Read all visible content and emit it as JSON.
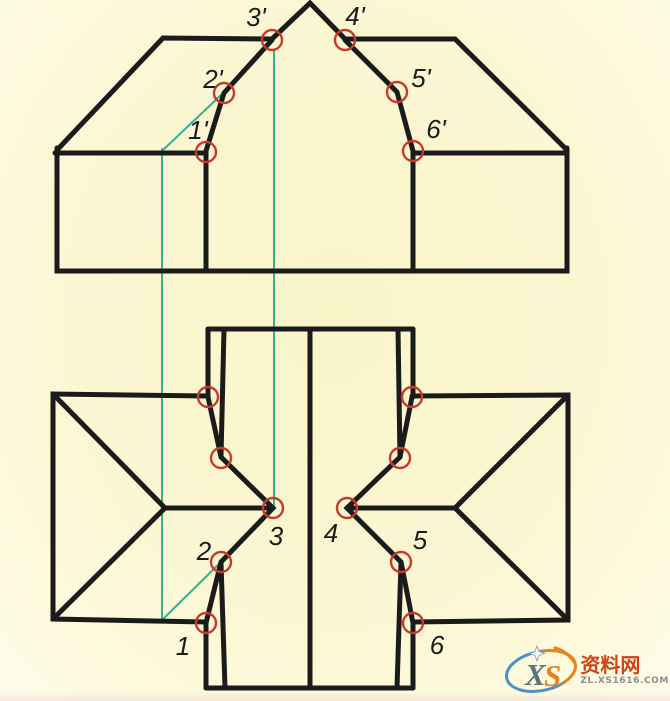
{
  "title": "orthographic-projection-construction-drawing",
  "colors": {
    "background": "#FBF7D3",
    "line": "#1B1B1B",
    "marker": "#C8392B",
    "construction": "#34B18F",
    "watermark_brand": "#CE4518",
    "watermark_domain": "#8E8E8E",
    "logo_blue": "#4E8FC4",
    "logo_orange": "#E8831D",
    "logo_x": "#5E7082"
  },
  "front_view": {
    "name": "front view (elevation)",
    "points": [
      {
        "label": "1'",
        "x": 206,
        "y": 152,
        "label_x": 198,
        "label_y": 139
      },
      {
        "label": "2'",
        "x": 224,
        "y": 93,
        "label_x": 213,
        "label_y": 88
      },
      {
        "label": "3'",
        "x": 272,
        "y": 40,
        "label_x": 256,
        "label_y": 26
      },
      {
        "label": "4'",
        "x": 345,
        "y": 40,
        "label_x": 355,
        "label_y": 25
      },
      {
        "label": "5'",
        "x": 397,
        "y": 92,
        "label_x": 421,
        "label_y": 87
      },
      {
        "label": "6'",
        "x": 413,
        "y": 151,
        "label_x": 436,
        "label_y": 138
      }
    ]
  },
  "top_view": {
    "name": "top view (plan)",
    "points": [
      {
        "label": "",
        "x": 208,
        "y": 397
      },
      {
        "label": "",
        "x": 221,
        "y": 458
      },
      {
        "label": "3",
        "x": 273,
        "y": 508,
        "label_x": 276,
        "label_y": 545
      },
      {
        "label": "2",
        "x": 221,
        "y": 562,
        "label_x": 204,
        "label_y": 560
      },
      {
        "label": "1",
        "x": 206,
        "y": 623,
        "label_x": 183,
        "label_y": 655
      },
      {
        "label": "",
        "x": 412,
        "y": 397
      },
      {
        "label": "",
        "x": 400,
        "y": 458
      },
      {
        "label": "4",
        "x": 347,
        "y": 508,
        "label_x": 331,
        "label_y": 542
      },
      {
        "label": "5",
        "x": 401,
        "y": 562,
        "label_x": 420,
        "label_y": 549
      },
      {
        "label": "6",
        "x": 413,
        "y": 623,
        "label_x": 437,
        "label_y": 654
      }
    ]
  },
  "drawing": {
    "stroke_width_outline": 5,
    "stroke_width_construction": 2,
    "marker_radius": 10,
    "marker_stroke_width": 2.4,
    "front_outlines": [
      [
        [
          57,
          150
        ],
        [
          163,
          38
        ],
        [
          272,
          39
        ],
        [
          310,
          3
        ],
        [
          345,
          39
        ],
        [
          455,
          39
        ],
        [
          567,
          150
        ]
      ],
      [
        [
          57,
          148
        ],
        [
          57,
          271
        ],
        [
          567,
          271
        ],
        [
          567,
          148
        ]
      ],
      [
        [
          55,
          153
        ],
        [
          206,
          153
        ]
      ],
      [
        [
          414,
          153
        ],
        [
          567,
          153
        ]
      ],
      [
        [
          272,
          40
        ],
        [
          224,
          93
        ],
        [
          206,
          151
        ]
      ],
      [
        [
          345,
          40
        ],
        [
          397,
          92
        ],
        [
          413,
          151
        ]
      ],
      [
        [
          206,
          152
        ],
        [
          206,
          271
        ]
      ],
      [
        [
          413,
          152
        ],
        [
          413,
          271
        ]
      ]
    ],
    "top_outlines": [
      [
        [
          208,
          329
        ],
        [
          413,
          329
        ]
      ],
      [
        [
          310,
          329
        ],
        [
          310,
          688
        ]
      ],
      [
        [
          206,
          688
        ],
        [
          413,
          688
        ]
      ],
      [
        [
          208,
          329
        ],
        [
          208,
          397
        ]
      ],
      [
        [
          224,
          329
        ],
        [
          221,
          457
        ]
      ],
      [
        [
          398,
          329
        ],
        [
          400,
          457
        ]
      ],
      [
        [
          413,
          329
        ],
        [
          413,
          397
        ]
      ],
      [
        [
          208,
          396
        ],
        [
          53,
          394
        ],
        [
          53,
          619
        ],
        [
          206,
          622
        ]
      ],
      [
        [
          53,
          394
        ],
        [
          165,
          508
        ],
        [
          53,
          619
        ]
      ],
      [
        [
          165,
          508
        ],
        [
          273,
          508
        ]
      ],
      [
        [
          208,
          397
        ],
        [
          221,
          457
        ],
        [
          273,
          508
        ],
        [
          221,
          562
        ],
        [
          206,
          623
        ]
      ],
      [
        [
          206,
          623
        ],
        [
          206,
          688
        ]
      ],
      [
        [
          221,
          563
        ],
        [
          225,
          688
        ]
      ],
      [
        [
          412,
          396
        ],
        [
          568,
          395
        ],
        [
          568,
          620
        ],
        [
          413,
          622
        ]
      ],
      [
        [
          568,
          395
        ],
        [
          455,
          508
        ],
        [
          568,
          620
        ]
      ],
      [
        [
          347,
          508
        ],
        [
          455,
          508
        ]
      ],
      [
        [
          412,
          397
        ],
        [
          400,
          457
        ],
        [
          347,
          508
        ],
        [
          401,
          562
        ],
        [
          413,
          623
        ]
      ],
      [
        [
          413,
          623
        ],
        [
          413,
          688
        ]
      ],
      [
        [
          401,
          563
        ],
        [
          397,
          688
        ]
      ]
    ],
    "construction_lines": [
      [
        [
          162,
          149
        ],
        [
          162,
          620
        ]
      ],
      [
        [
          274,
          50
        ],
        [
          274,
          508
        ]
      ],
      [
        [
          163,
          150
        ],
        [
          221,
          95
        ]
      ],
      [
        [
          221,
          562
        ],
        [
          162,
          620
        ]
      ]
    ]
  },
  "watermark": {
    "brand": "资料网",
    "domain": "ZL.XS1616.COM",
    "logo_letter_x": "X",
    "logo_letter_s": "S"
  }
}
